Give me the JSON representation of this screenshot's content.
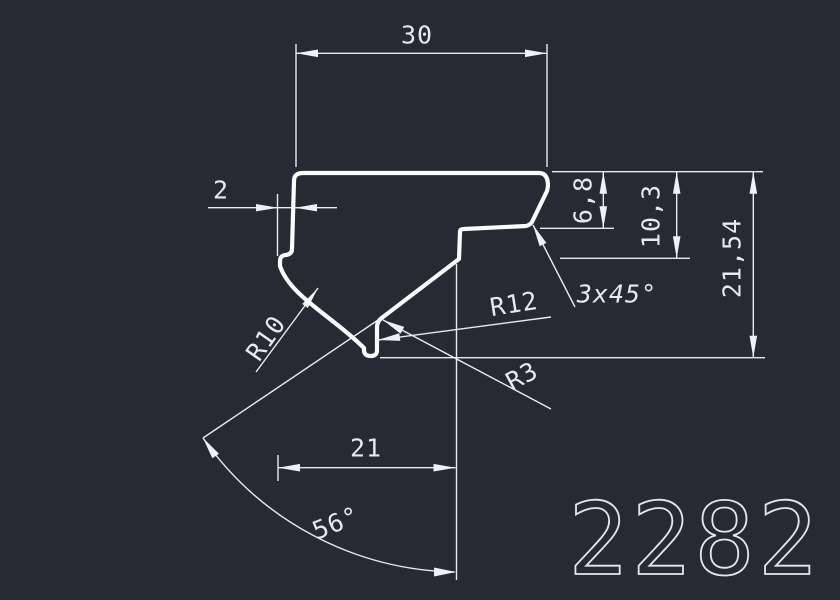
{
  "drawing": {
    "type": "profile-cross-section",
    "drawing_number": "2282",
    "labels": {
      "top_width": "30",
      "left_offset": "2",
      "chamfer_depth": "6,8",
      "step_depth": "10,3",
      "total_depth": "21,54",
      "chamfer_note": "3x45°",
      "radius_r12": "R12",
      "radius_r3": "R3",
      "radius_r10": "R10",
      "bottom_width": "21",
      "groove_angle": "56°"
    },
    "colors": {
      "background": "#252a33",
      "thin_lines": "#e8ecf1",
      "profile_outline": "#fafbfc",
      "text": "#e6eaef"
    }
  }
}
